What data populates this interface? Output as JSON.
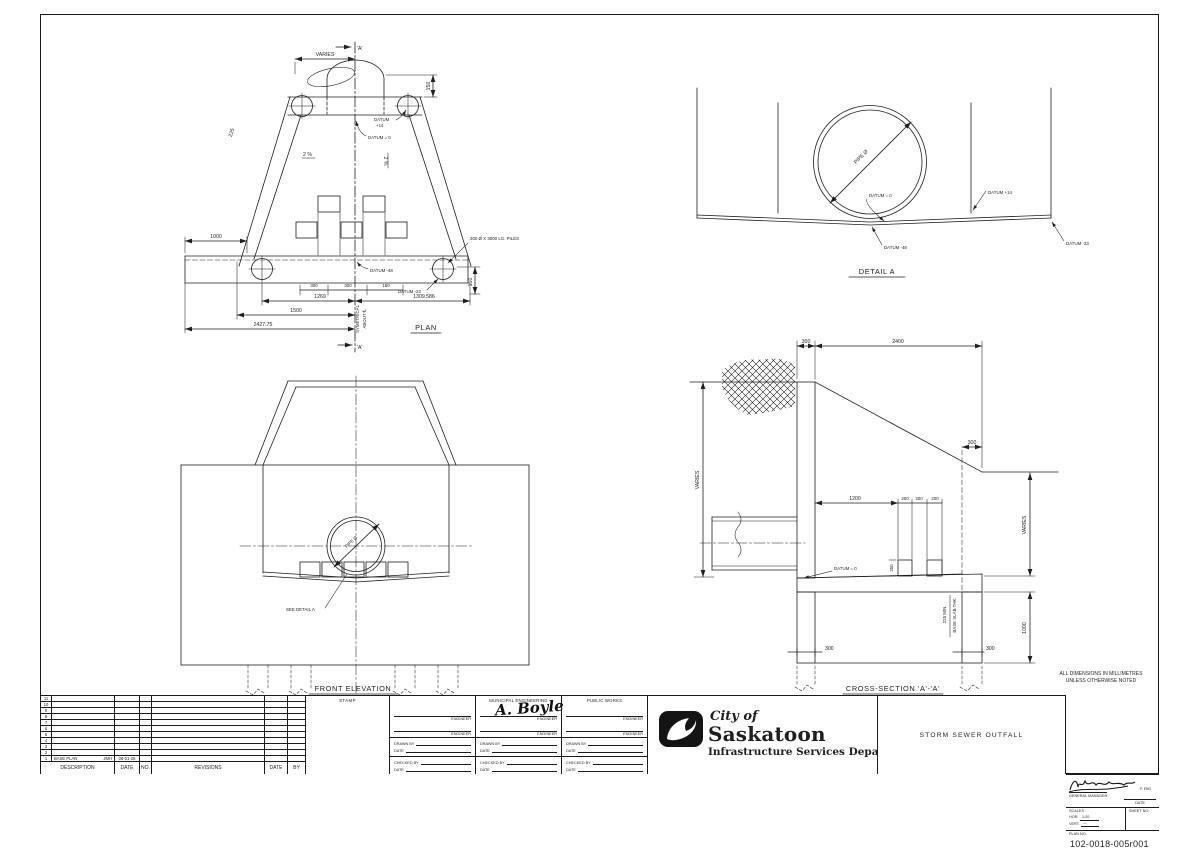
{
  "sheet": {
    "notes_line1": "ALL DIMENSIONS IN MILLIMETRES",
    "notes_line2": "UNLESS OTHERWISE NOTED"
  },
  "plan": {
    "title": "PLAN",
    "marker_top": "'A'",
    "marker_bottom": "'A'",
    "varies": "VARIES",
    "dim_150_top": "150",
    "dim_225": "225",
    "slope_left": "2 %",
    "slope_right": "2 %",
    "datum_plus14_line1": "DATUM",
    "datum_plus14_line2": "+14",
    "datum_zero": "DATUM = 0",
    "datum_minus48": "DATUM -48",
    "datum_minus23": "DATUM -23",
    "piles_note": "300 Ø X 3000 LG. PILES",
    "dim_1000": "1000",
    "dim_300_a": "300",
    "dim_300_b": "300",
    "dim_150_mid": "150",
    "dim_1269": "1269",
    "dim_1309_586": "1309.586",
    "dim_1500": "1500",
    "dim_2427_75": "2427.75",
    "dim_150_right": "150",
    "symmetrical_line1": "SYMETRICAL",
    "symmetrical_line2": "ABOUT ℄"
  },
  "detail_a": {
    "title": "DETAIL A",
    "pipe_label": "PIPE Ø",
    "datum_zero": "DATUM = 0",
    "datum_plus14": "DATUM +14",
    "datum_minus48": "DATUM -48",
    "datum_minus23": "DATUM -23"
  },
  "front_elevation": {
    "title": "FRONT ELEVATION",
    "pipe_label": "PIPE Ø",
    "see_detail_a": "SEE DETAIL A"
  },
  "cross_section": {
    "title": "CROSS-SECTION 'A'-'A'",
    "dim_300_top": "300",
    "dim_2400": "2400",
    "varies_left": "VARIES",
    "dim_300_mid": "300",
    "varies_right": "VARIES",
    "dim_1200": "1200",
    "dim_200_a": "200",
    "dim_200_b": "200",
    "dim_200_c": "200",
    "dim_200_v": "200",
    "datum_zero": "DATUM = 0",
    "slab_line1": "225 MIN",
    "slab_line2": "BASE SLAB THK.",
    "dim_300_bot_left": "300",
    "dim_300_bot_right": "300",
    "dim_1000": "1000"
  },
  "title_block": {
    "revisions": {
      "headers": [
        "DESCRIPTION",
        "DATE",
        "NO.",
        "REVISIONS",
        "DATE",
        "BY"
      ],
      "row_numbers": [
        "11",
        "10",
        "9",
        "8",
        "7",
        "6",
        "5",
        "4",
        "3",
        "2",
        "1"
      ],
      "entry": {
        "description": "BASE PLAN",
        "by": "JMH",
        "date": "06-01-25"
      }
    },
    "stamp_label": "STAMP",
    "approvals": {
      "columns": [
        {
          "title": ""
        },
        {
          "title": "MUNICIPAL ENGINEERING"
        },
        {
          "title": "PUBLIC WORKS"
        }
      ],
      "engineer_label": "ENGINEER",
      "drawn_by_label": "DRAWN BY",
      "checked_by_label": "CHECKED BY",
      "date_label": "DATE",
      "signature": "A. Boyle"
    },
    "agency": {
      "city_of": "City of",
      "name": "Saskatoon",
      "department": "Infrastructure Services Department"
    },
    "drawing_title": "STORM SEWER OUTFALL",
    "approval_box": {
      "general_manager_label": "GENERAL MANAGER",
      "p_eng": "P. ENG",
      "date_label": "DATE",
      "scales_label": "SCALES :",
      "hor_label": "HOR.",
      "hor_value": "1:20",
      "vert_label": "VERT.",
      "vert_value": "—",
      "sheet_no_label": "SHEET NO.",
      "plan_no_label": "PLAN NO.",
      "plan_no": "102-0018-005r001"
    }
  }
}
